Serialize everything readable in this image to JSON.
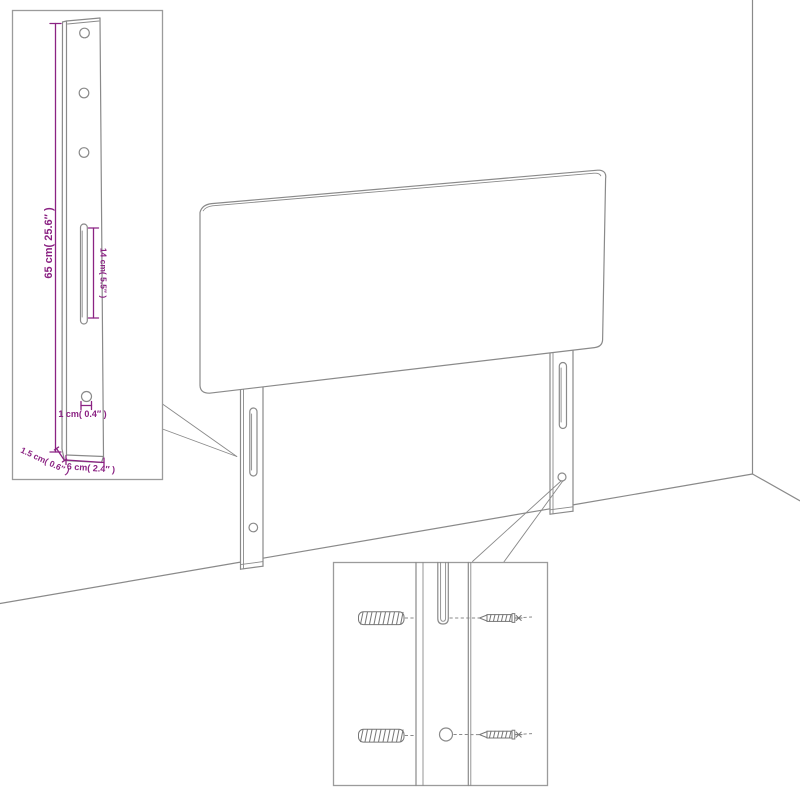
{
  "diagram": {
    "title": "headboard-assembly-dimension-diagram",
    "colors": {
      "background": "#ffffff",
      "line": "#8a8a8a",
      "dimension": "#8b2383"
    },
    "leg_detail_inset": {
      "labels": {
        "height": "65 cm( 25.6″ )",
        "slot_length": "14 cm( 5.5″ )",
        "hole_diameter": "1 cm( 0.4″ )",
        "depth": "1.5 cm( 0.6″ )",
        "width": "6 cm( 2.4″ )"
      }
    }
  }
}
